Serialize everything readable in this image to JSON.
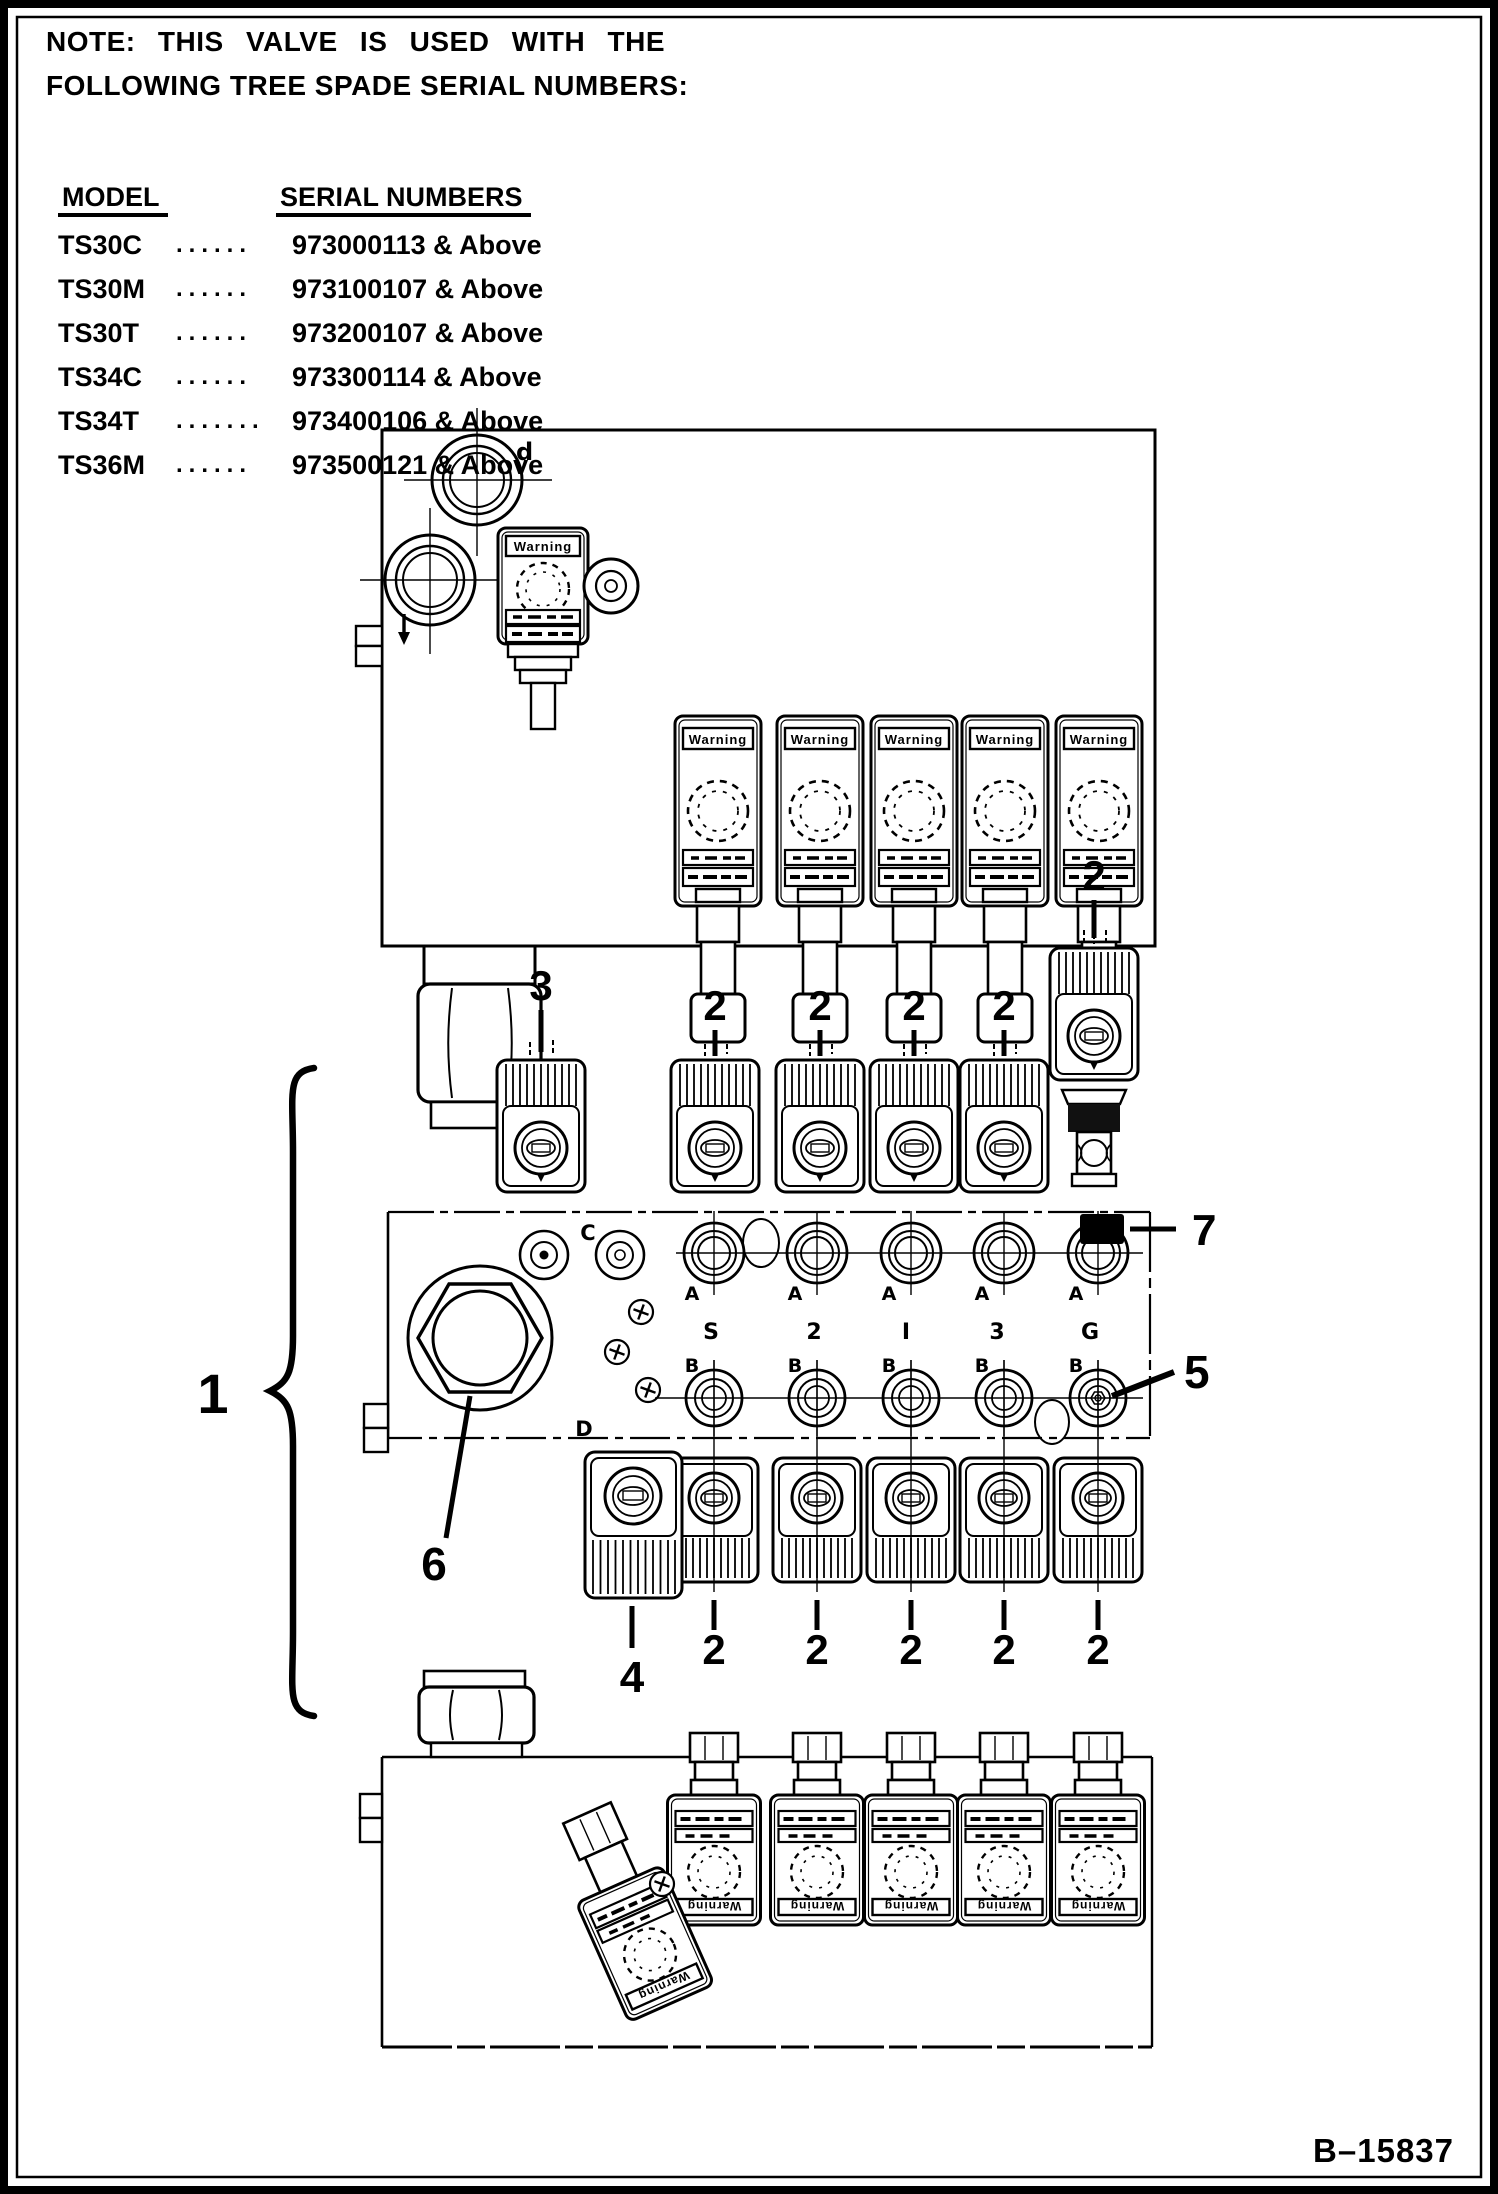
{
  "note": {
    "line1": "NOTE: THIS VALVE IS USED WITH THE",
    "line2": "FOLLOWING TREE SPADE SERIAL NUMBERS:"
  },
  "serial_table": {
    "col_model": "MODEL",
    "col_serial": "SERIAL NUMBERS",
    "rows": [
      {
        "model": "TS30C",
        "dots": "......",
        "serial": "973000113 & Above"
      },
      {
        "model": "TS30M",
        "dots": "......",
        "serial": "973100107 & Above"
      },
      {
        "model": "TS30T",
        "dots": "......",
        "serial": "973200107 & Above"
      },
      {
        "model": "TS34C",
        "dots": "......",
        "serial": "973300114 & Above"
      },
      {
        "model": "TS34T",
        "dots": ".......",
        "serial": "973400106 & Above"
      },
      {
        "model": "TS36M",
        "dots": "......",
        "serial": "973500121 & Above"
      }
    ]
  },
  "callouts": {
    "c1": "1",
    "c2": "2",
    "c3": "3",
    "c4": "4",
    "c5": "5",
    "c6": "6",
    "c7": "7"
  },
  "ports": {
    "c": "C",
    "d": "D",
    "top_mark": "d",
    "a": "A",
    "b": "B",
    "s1": "S",
    "s2": "2",
    "s3": "I",
    "s4": "3",
    "s5": "G"
  },
  "coil": {
    "brand": "Warning"
  },
  "figure_ref": "B–15837"
}
